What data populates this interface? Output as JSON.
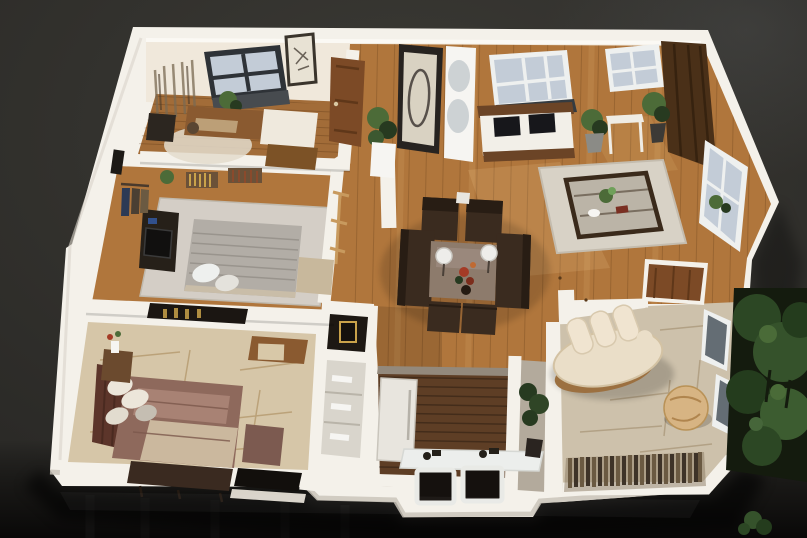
{
  "scene": {
    "title": "3D apartment floor plan render",
    "description": "Photorealistic isometric dollhouse cutaway render of a furnished one-level apartment, viewed from above on a dark charcoal studio background with greenery outside the right wall",
    "view": "isometric cutaway, no visible text",
    "background": "dark textured charcoal with glossy near-black foreground floor"
  },
  "palette": {
    "bg": "#2b2a27",
    "bgLight": "#4a4a46",
    "bgTopRight": "#3f4144",
    "bgBottom": "#0b0a09",
    "wall": "#f4f1ea",
    "wallShade": "#d9d4ca",
    "wallFace": "#f0e8db",
    "wallEdge": "#bfb9ad",
    "wood": "#b0763c",
    "woodLight": "#d8a05e",
    "woodDark": "#7c4e24",
    "studyWood": "#a26c38",
    "kitchenWood": "#5e3e25",
    "kitchenWoodDark": "#3f2b19",
    "tile": "#d6c6a8",
    "tileVein": "#b1966a",
    "loungeTile": "#cdc1ab",
    "loungeVein": "#a08c6c",
    "rugMaster": "#d4cec6",
    "rugLiving": "#d8d2c6",
    "bedGrey": "#b2ada6",
    "bedGreyDark": "#99948d",
    "mauve": "#8e695c",
    "mauveLight": "#a88274",
    "headboard": "#5c352a",
    "benchDark": "#3a2a20",
    "espresso": "#3a2b1f",
    "espressoDark": "#281d14",
    "taupe": "#8d7b6c",
    "taupeLight": "#a5948a",
    "cream": "#eadec8",
    "creamShade": "#d3c2a3",
    "pouf": "#d7b483",
    "sofaWood": "#9c7040",
    "glass": "#c3ccd7",
    "glassDark": "#646d74",
    "frameDark": "#2e3237",
    "sillDark": "#353b40",
    "doorWood": "#7c4a26",
    "doorWoodDark": "#5f3719",
    "walnut": "#4a3018",
    "walnutDark": "#36220f",
    "mirrorFrame": "#272320",
    "mirrorFace": "#d9d2c2",
    "plant": "#4c6b38",
    "plantDark": "#273a20",
    "garden": "#33502a",
    "gardenDark": "#141b0e",
    "blackPillow": "#17171b",
    "white": "#f6f5f2",
    "fridge": "#e8e5de",
    "counter": "#eceeec",
    "steel": "#242019",
    "fringe": "#6b5a42",
    "fringeDark": "#3e3328",
    "gold": "#c9a24a",
    "red": "#a43b26",
    "blue": "#31508c"
  },
  "rooms": [
    {
      "id": "study",
      "name": "study-office",
      "floor": "hardwood",
      "furniture": [
        "desk",
        "desk-chair",
        "daybed-with-drawers",
        "round-rug",
        "dark-frame-window",
        "framed-art",
        "wall-sketches"
      ]
    },
    {
      "id": "entry",
      "name": "entry-hall",
      "floor": "hardwood",
      "furniture": [
        "wood-interior-door",
        "dark-framed-mirror-panel",
        "curved-niche-shelf-column",
        "potted-plant",
        "wall-stub"
      ]
    },
    {
      "id": "living",
      "name": "living-room",
      "floor": "hardwood",
      "furniture": [
        "wood-frame-bench-sofa",
        "two-black-pillows",
        "two-potted-plants",
        "console-table",
        "glass-coffee-table",
        "light-area-rug",
        "two-top-windows",
        "tall-side-window",
        "walnut-accent-panel"
      ]
    },
    {
      "id": "center",
      "name": "conversation-area",
      "floor": "hardwood",
      "furniture": [
        "two-espresso-armchairs",
        "two-espresso-loveseats",
        "two-ottomans",
        "taupe-center-table",
        "two-sphere-lamps",
        "red-centerpiece"
      ]
    },
    {
      "id": "master",
      "name": "master-bedroom",
      "floor": "hardwood with grey rug",
      "furniture": [
        "grey-double-bed",
        "white-pillows",
        "dark-dresser-tv-unit",
        "clothes-rack",
        "book-shelves",
        "foot-bench",
        "valet-chair",
        "plant"
      ]
    },
    {
      "id": "bedroom2",
      "name": "second-bedroom",
      "floor": "beige stone tile",
      "furniture": [
        "mauve-double-bed",
        "dark-headboard",
        "white-pillows",
        "mauve-ottoman",
        "dark-foot-bench",
        "flower-side-table",
        "corner-desk",
        "wall-niche-with-bottles",
        "door-opening"
      ]
    },
    {
      "id": "kitchen",
      "name": "kitchen-nook",
      "floor": "dark plank wood",
      "furniture": [
        "tall-white-cabinet",
        "white-counter",
        "cooktop-fixtures",
        "two-bar-stools"
      ]
    },
    {
      "id": "pantry",
      "name": "utility-niche",
      "floor": "stone",
      "furniture": [
        "dark-potted-plant"
      ]
    },
    {
      "id": "lounge",
      "name": "sun-lounge",
      "floor": "beige stone tile",
      "furniture": [
        "curved-cream-sofa",
        "round-pouf",
        "fringe-runner",
        "two-side-windows",
        "wood-closet-doors"
      ]
    },
    {
      "id": "garden",
      "name": "outdoor-greenery",
      "floor": "none",
      "furniture": [
        "shrubs",
        "small-tree",
        "grass-tuft"
      ]
    }
  ]
}
